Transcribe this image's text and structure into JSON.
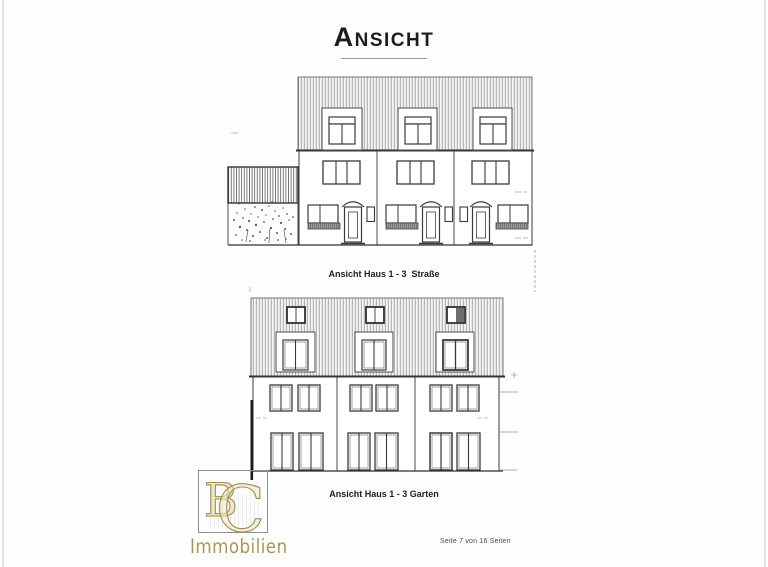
{
  "page": {
    "title": "Ansicht",
    "footer": "Seite 7 von 16 Seiten"
  },
  "drawings": [
    {
      "name": "street-elevation",
      "caption": "Ansicht Haus 1 - 3  Straße"
    },
    {
      "name": "garden-elevation",
      "caption": "Ansicht Haus 1 - 3 Garten"
    }
  ],
  "logo": {
    "monogram_b": "B",
    "monogram_c": "C",
    "subtitle": "Immobilien",
    "accent_gold": "#a9975a",
    "fill_cream": "#efe6c8"
  },
  "colors": {
    "line_art": "#3a3a3a",
    "hatch": "#777777",
    "page_background": "#fefefe"
  }
}
